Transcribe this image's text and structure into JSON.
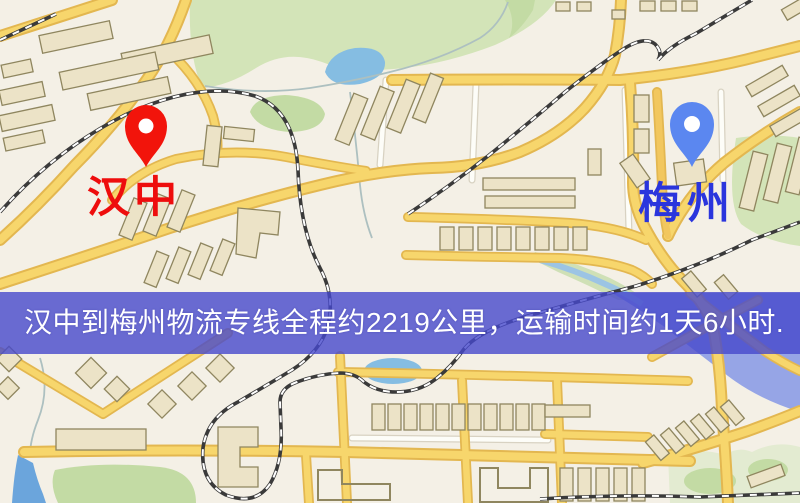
{
  "banner": {
    "text": "汉中到梅州物流专线全程约2219公里，运输时间约1天6小时.",
    "background_color": "rgba(70,73,204,0.80)",
    "text_color": "#ffffff"
  },
  "route": {
    "origin": "汉中",
    "destination": "梅州",
    "distance_text": "约2219公里",
    "duration_text": "约1天6小时"
  },
  "markers": {
    "origin": {
      "label": "汉中",
      "icon": "location-pin",
      "pin_color": "#f2140b",
      "label_color": "#ee0d0d"
    },
    "destination": {
      "label": "梅州",
      "icon": "location-pin",
      "pin_color": "#5b87f0",
      "label_color": "#2a35dd"
    }
  },
  "map_style": {
    "background": "#f4f0e6",
    "road_fill": "#f7d66c",
    "road_casing": "#e3b750",
    "park_green": "#d3e4b8",
    "water_blue": "#85bde2",
    "water_wedge_blue": "#96a5e6",
    "building_fill": "#ece3c7",
    "building_stroke": "#8f865f",
    "railway_dark": "#3a3a3a"
  }
}
